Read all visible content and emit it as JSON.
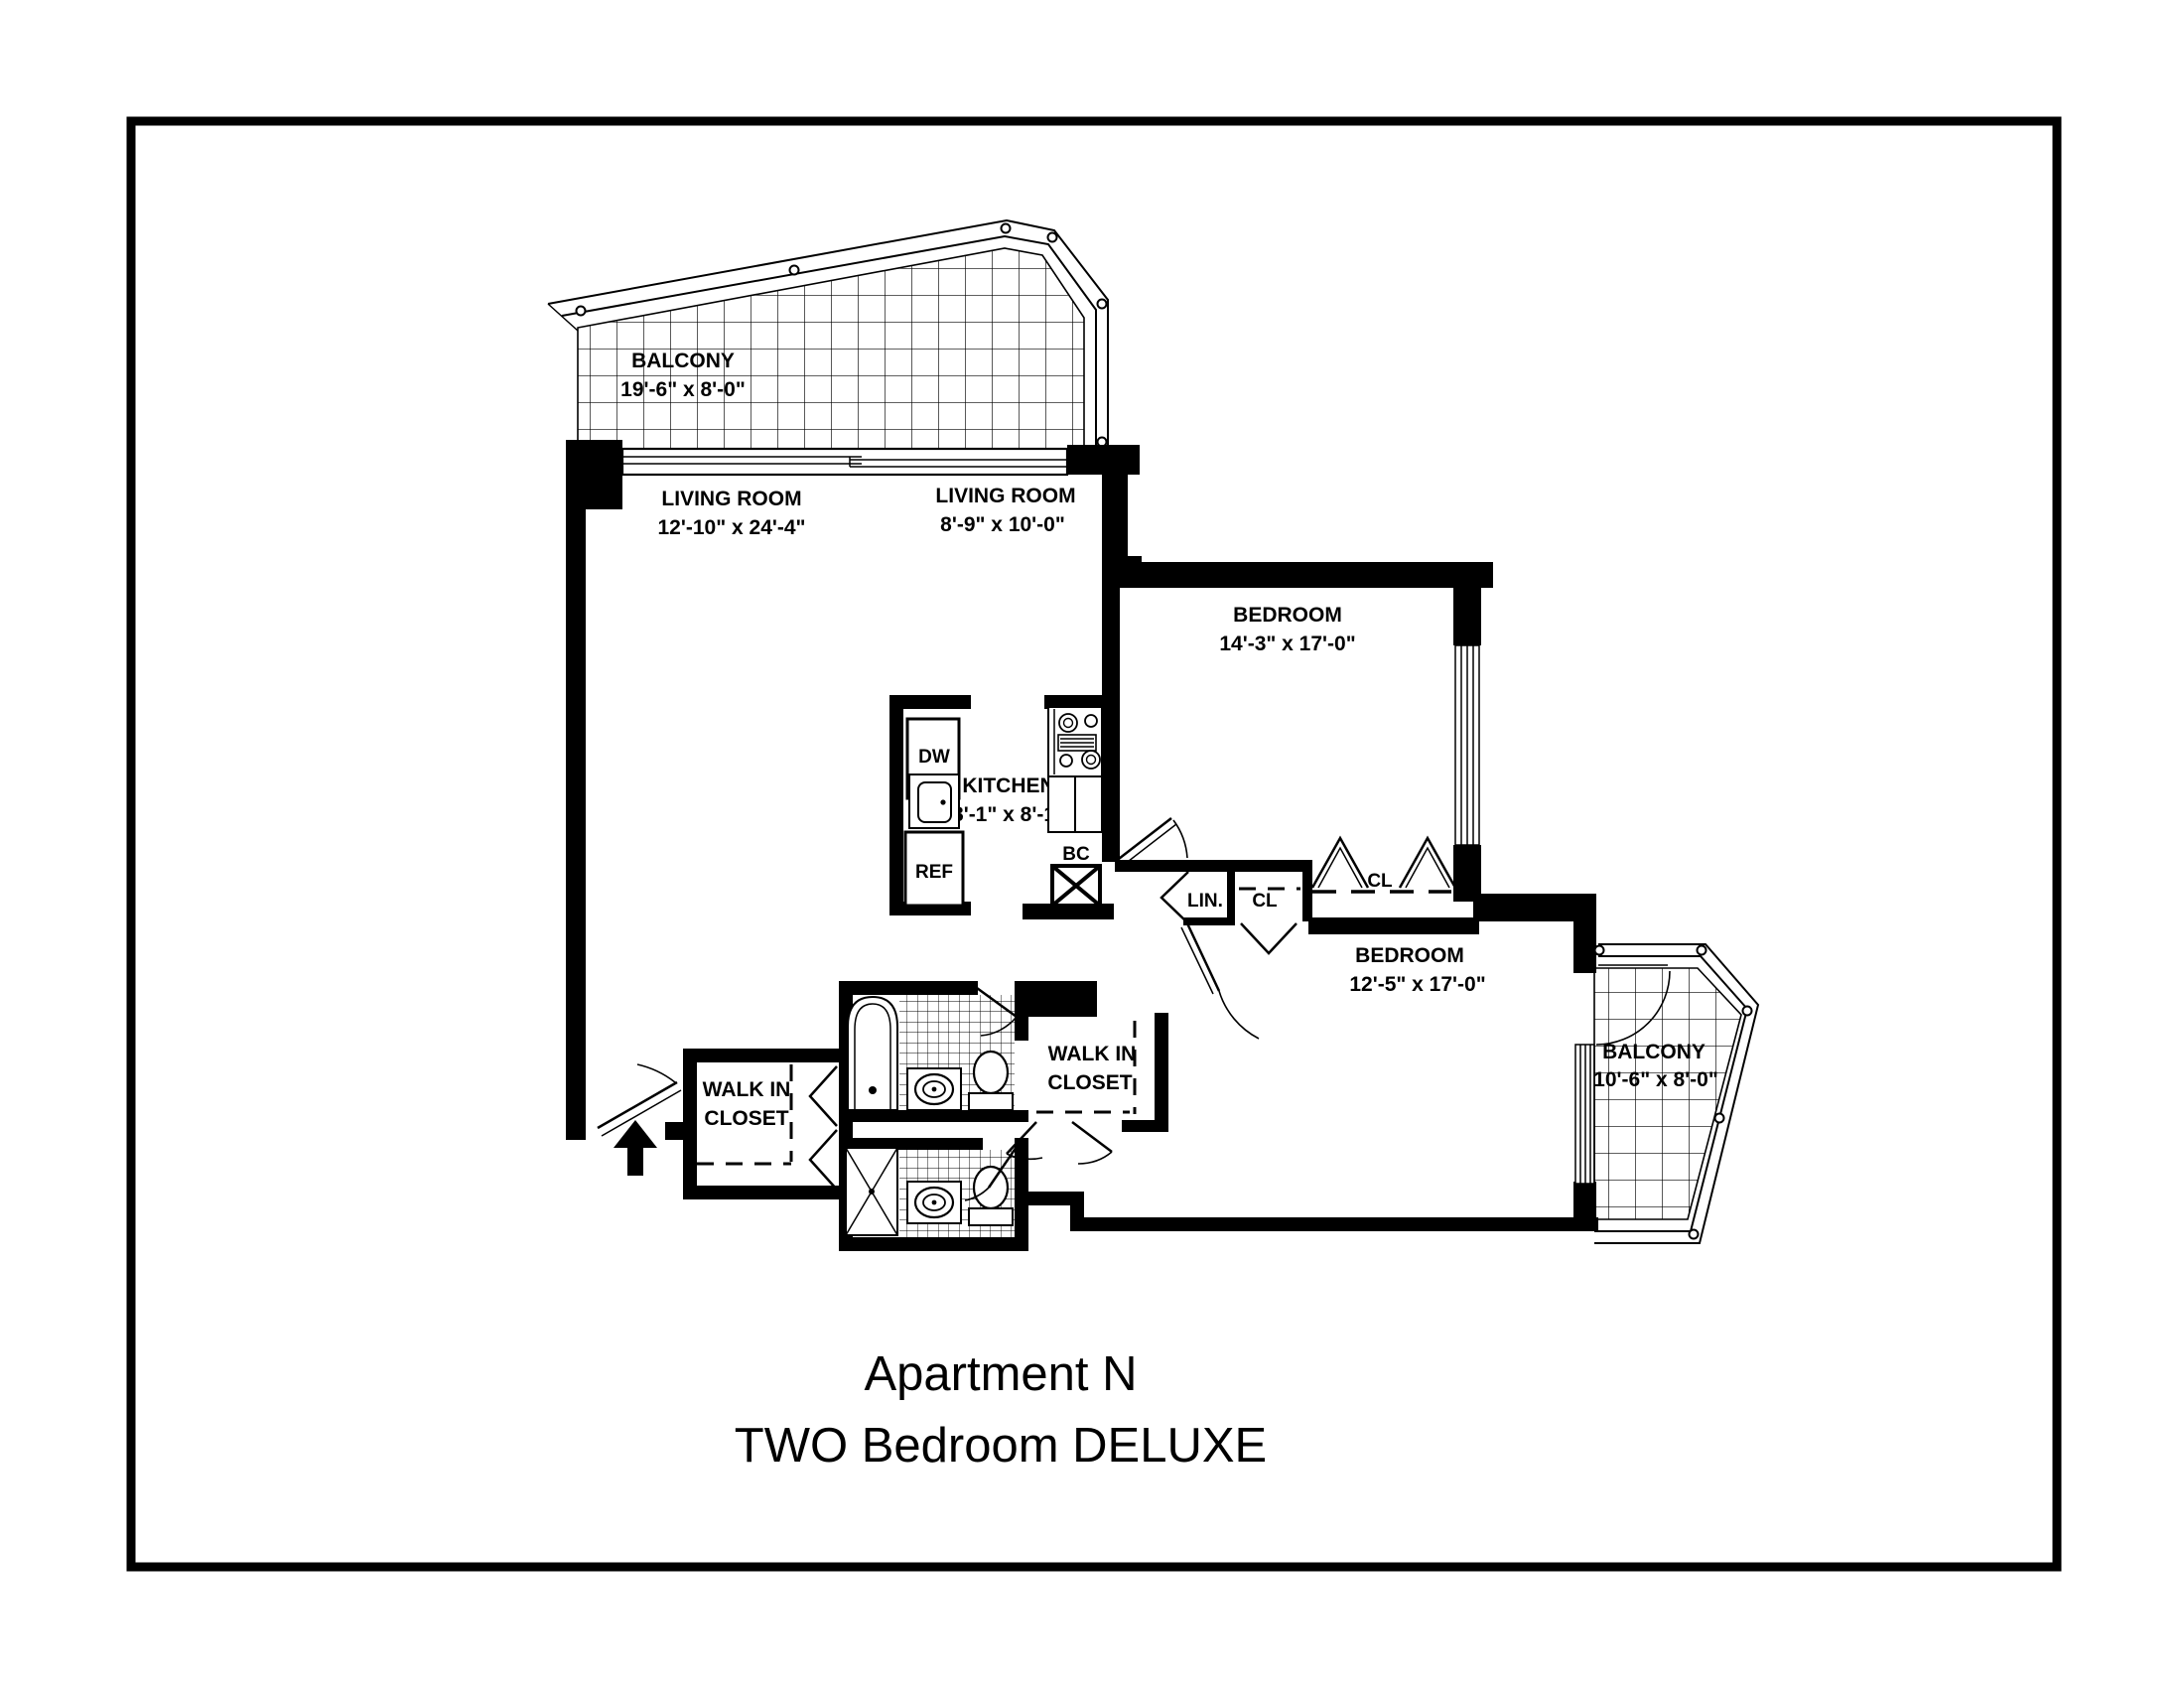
{
  "title": {
    "line1": "Apartment N",
    "line2": "TWO Bedroom DELUXE"
  },
  "rooms": {
    "balcony_top": {
      "name": "BALCONY",
      "dims": "19'-6\" x 8'-0\""
    },
    "living_main": {
      "name": "LIVING ROOM",
      "dims": "12'-10\" x 24'-4\""
    },
    "living_alcove": {
      "name": "LIVING ROOM",
      "dims": "8'-9\" x 10'-0\""
    },
    "bedroom_top": {
      "name": "BEDROOM",
      "dims": "14'-3\" x 17'-0\""
    },
    "kitchen": {
      "name": "KITCHEN",
      "dims": "8'-1\" x 8'-1\""
    },
    "bedroom_bottom": {
      "name": "BEDROOM",
      "dims": "12'-5\" x 17'-0\""
    },
    "balcony_bottom": {
      "name": "BALCONY",
      "dims": "10'-6\" x 8'-0\""
    },
    "walkin_closet_entry": {
      "line1": "WALK IN",
      "line2": "CLOSET"
    },
    "walkin_closet_bedroom": {
      "line1": "WALK IN",
      "line2": "CLOSET"
    }
  },
  "fixtures": {
    "dishwasher": "DW",
    "refrigerator": "REF",
    "base_cabinet": "BC",
    "linen_closet": "LIN.",
    "closet_hall": "CL",
    "closet_bedroom": "CL"
  },
  "colors": {
    "line": "#000000",
    "background": "#ffffff"
  }
}
